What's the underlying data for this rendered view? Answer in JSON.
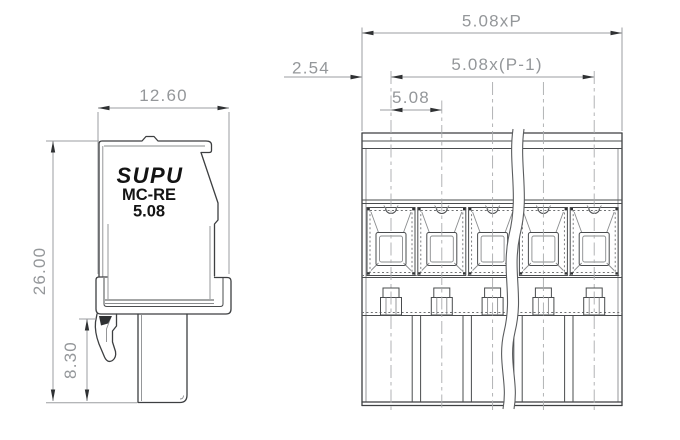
{
  "drawing_type": "technical-dimension-drawing",
  "part": {
    "brand": "SUPU",
    "model": "MC-RE",
    "pitch_code": "5.08",
    "poles_shown": 5
  },
  "side_view": {
    "label_brand": "SUPU",
    "label_model": "MC-RE",
    "label_pitch": "5.08",
    "dim_width": "12.60",
    "dim_height": "26.00",
    "dim_lower_height": "8.30"
  },
  "front_view": {
    "dim_total_width": "5.08xP",
    "dim_pole_span": "5.08x(P-1)",
    "dim_pitch": "5.08",
    "dim_edge_to_center": "2.54"
  },
  "colors": {
    "background": "#ffffff",
    "outline": "#3d3f41",
    "inner_line": "#8a8c8e",
    "dimension_line": "#9b9da0",
    "dimension_text": "#94979a",
    "arrow": "#2f3133",
    "logo_text": "#141414"
  }
}
